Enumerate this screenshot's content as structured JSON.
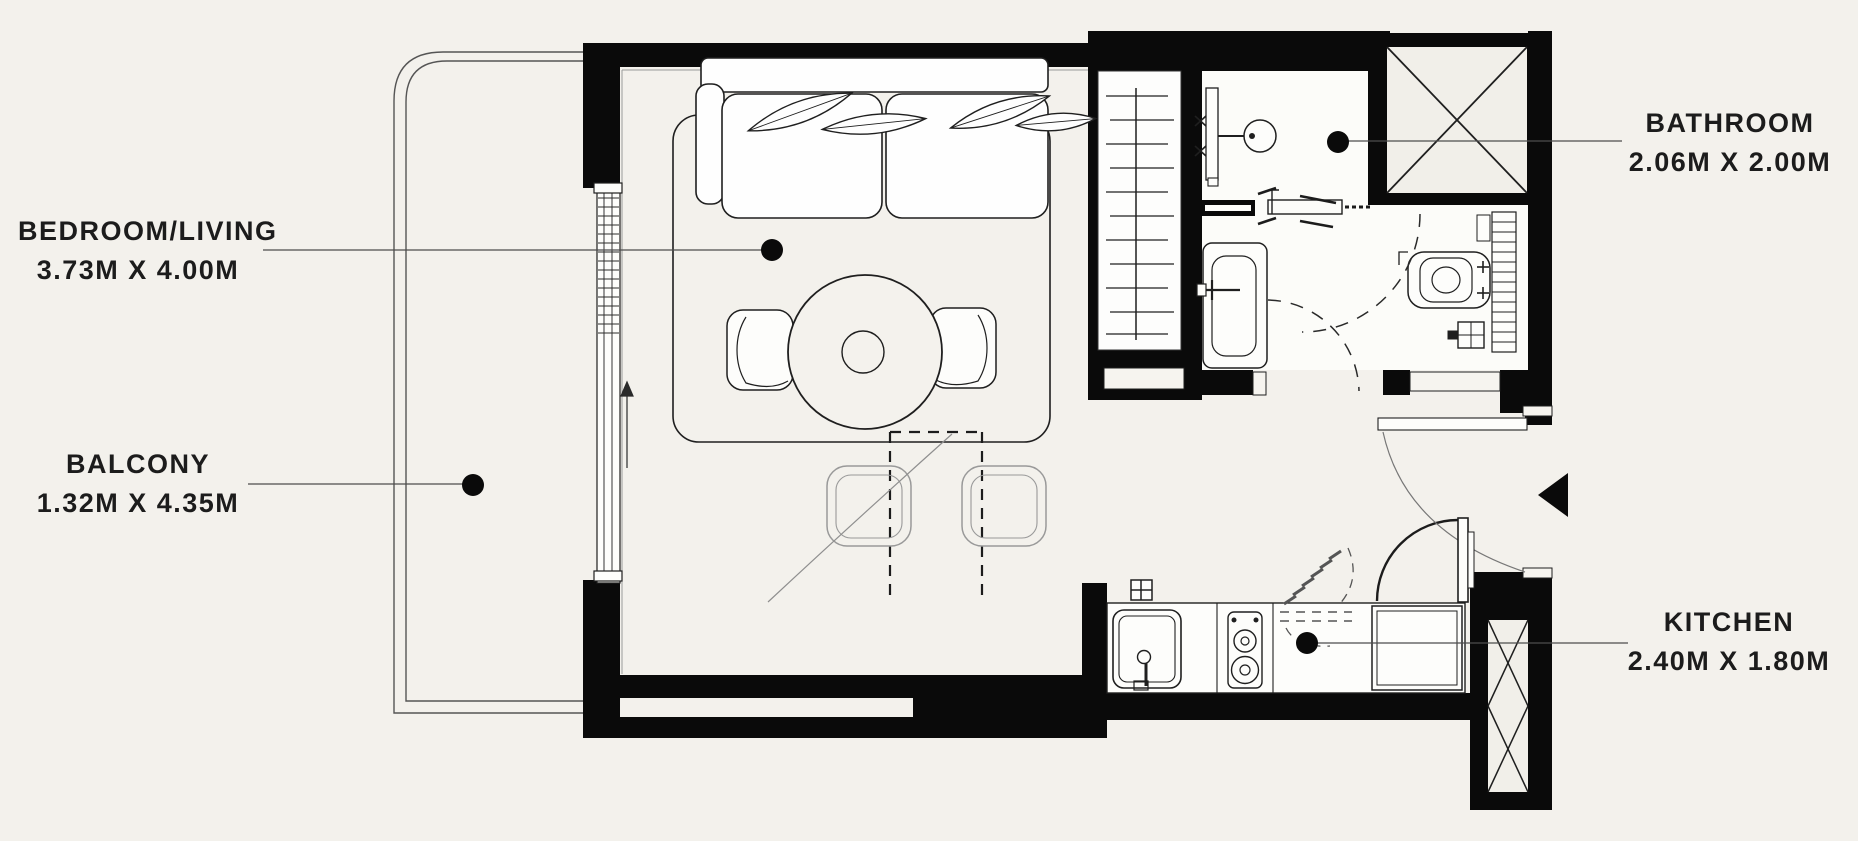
{
  "title": "Studio apartment floor plan",
  "rooms": [
    {
      "key": "bedroom_living",
      "name": "BEDROOM/LIVING",
      "dimensions": "3.73M X 4.00M"
    },
    {
      "key": "balcony",
      "name": "BALCONY",
      "dimensions": "1.32M X 4.35M"
    },
    {
      "key": "bathroom",
      "name": "BATHROOM",
      "dimensions": "2.06M X 2.00M"
    },
    {
      "key": "kitchen",
      "name": "KITCHEN",
      "dimensions": "2.40M X 1.80M"
    }
  ],
  "colors": {
    "background": "#f3f1ec",
    "wall": "#0a0a0a",
    "line": "#1f1f1f",
    "light_line": "#8f8f8f",
    "leader": "#4d4d4d",
    "fixture_fill": "#fdfdfb",
    "text": "#1c1c1c"
  }
}
